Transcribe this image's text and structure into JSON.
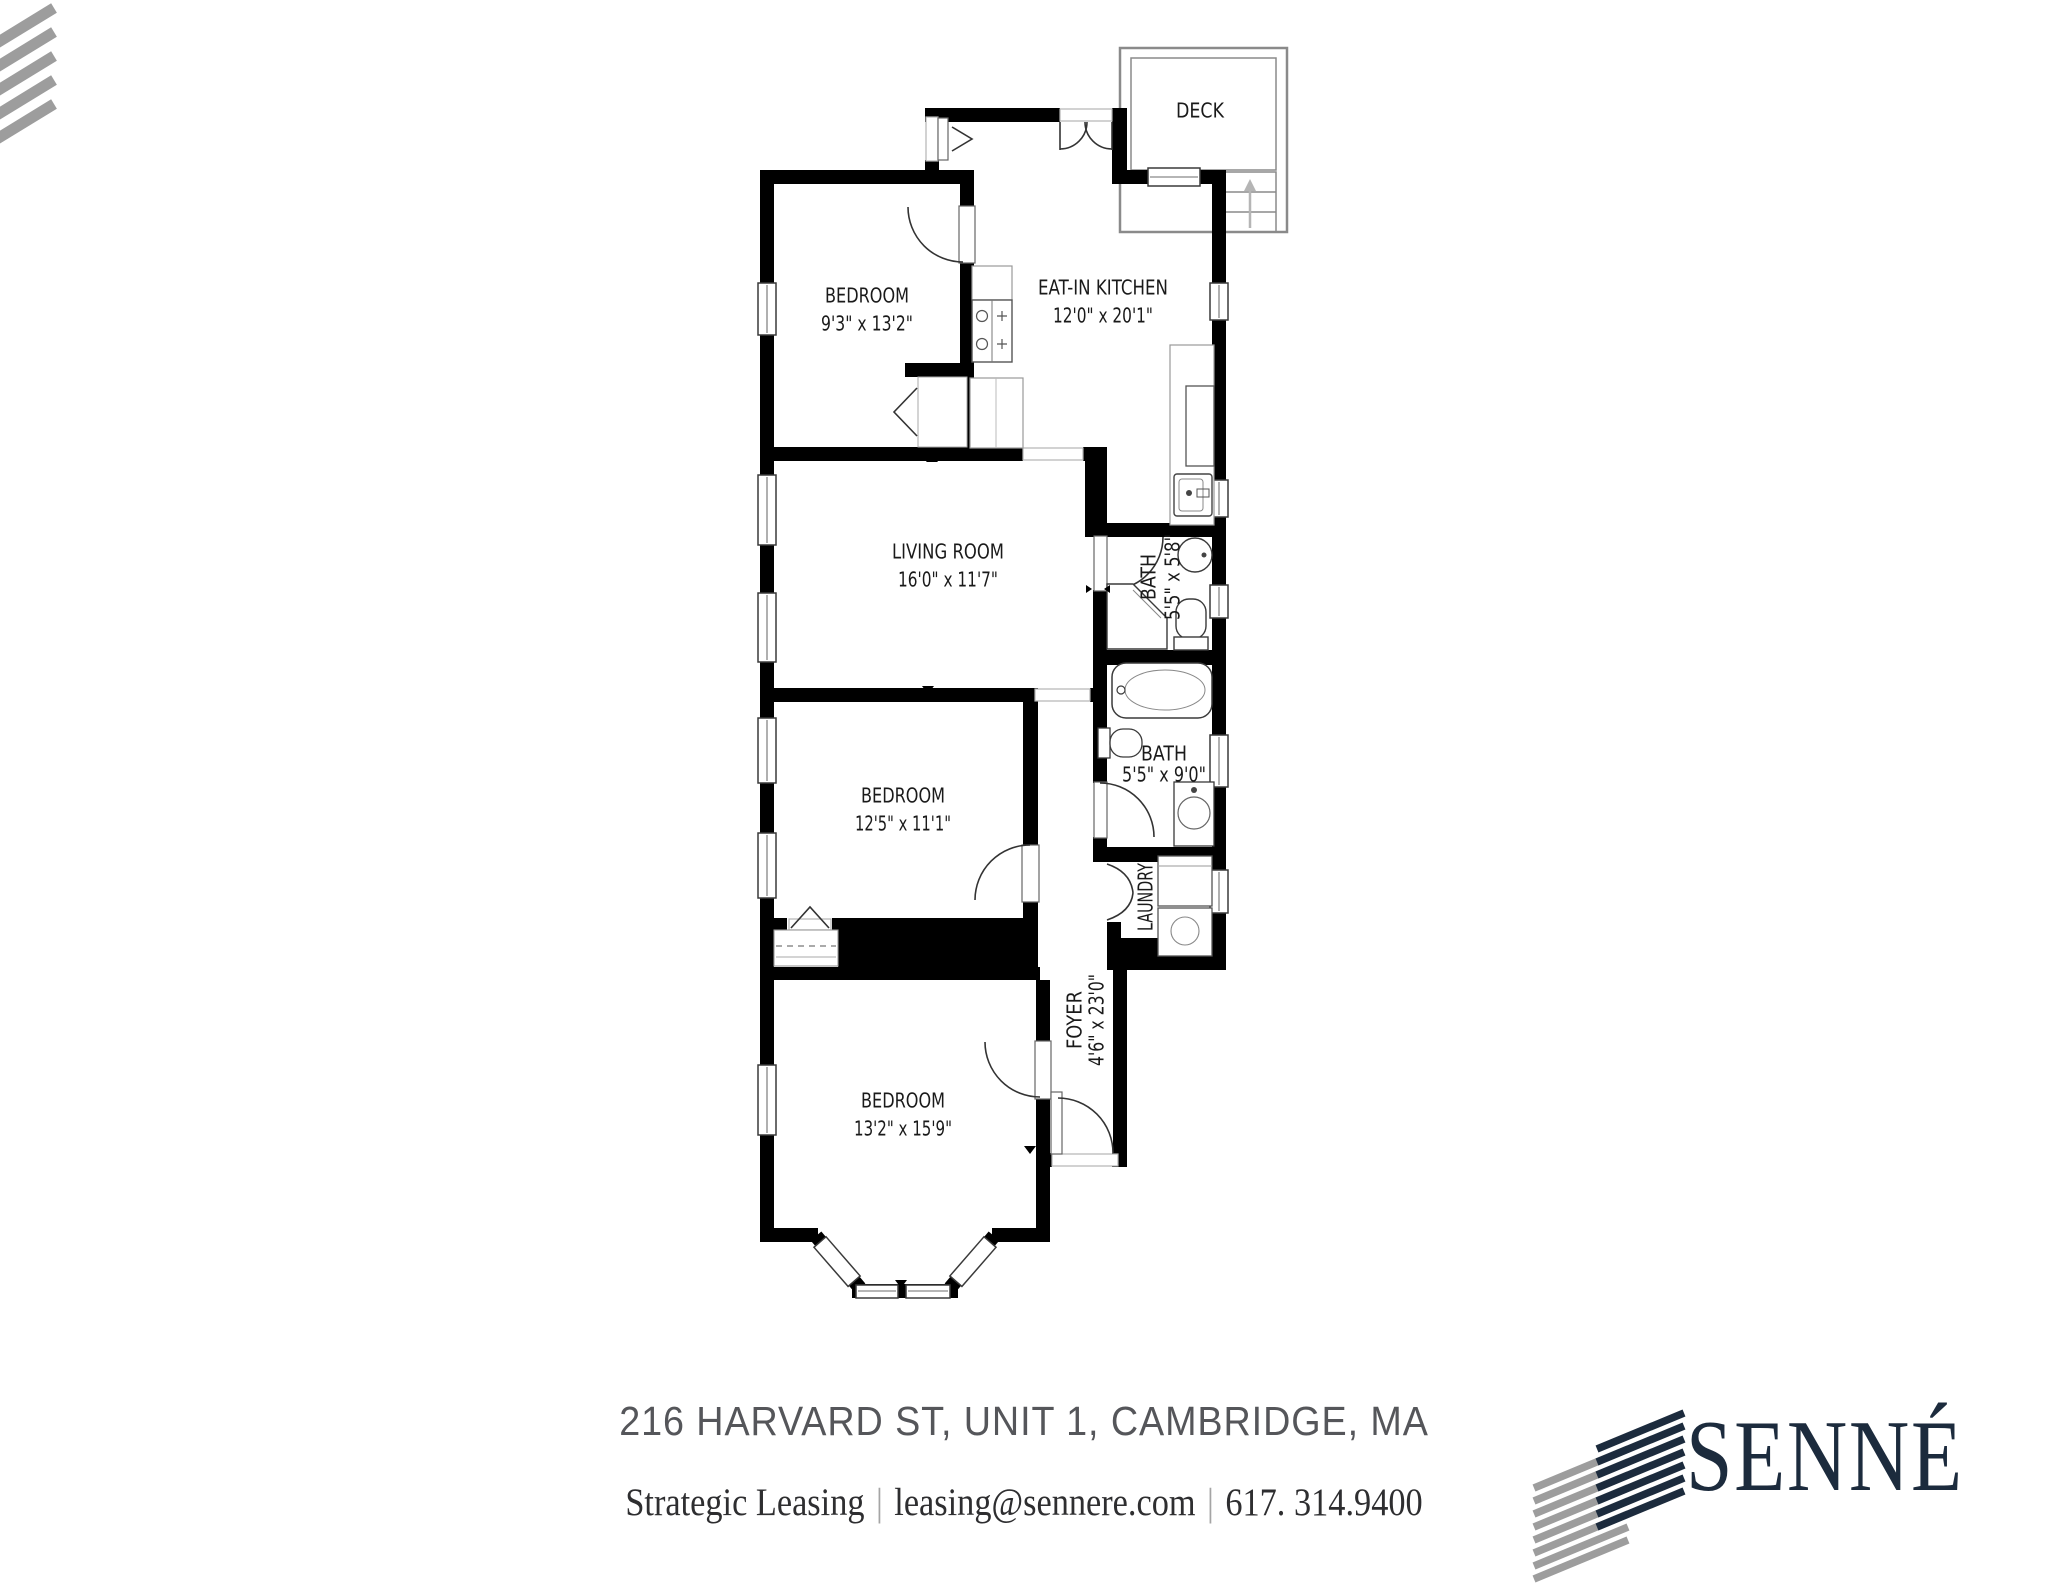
{
  "plan": {
    "wall_color": "#000000",
    "rooms": {
      "bedroom1": {
        "name": "BEDROOM",
        "dims": "9'3\" x 13'2\""
      },
      "kitchen": {
        "name": "EAT-IN KITCHEN",
        "dims": "12'0\" x 20'1\""
      },
      "deck": {
        "name": "DECK"
      },
      "living": {
        "name": "LIVING ROOM",
        "dims": "16'0\" x 11'7\""
      },
      "bath_small": {
        "name": "BATH",
        "dims": "5'5\" x 5'8\""
      },
      "bath_large": {
        "name": "BATH",
        "dims": "5'5\" x 9'0\""
      },
      "bedroom2": {
        "name": "BEDROOM",
        "dims": "12'5\" x 11'1\""
      },
      "laundry": {
        "name": "LAUNDRY"
      },
      "foyer": {
        "name": "FOYER",
        "dims": "4'6\" x 23'0\""
      },
      "bedroom3": {
        "name": "BEDROOM",
        "dims": "13'2\" x 15'9\""
      }
    }
  },
  "footer": {
    "address": "216 HARVARD ST, UNIT 1, CAMBRIDGE, MA",
    "company": "Strategic Leasing",
    "email": "leasing@sennere.com",
    "phone": "617. 314.9400",
    "separator": "|"
  },
  "branding": {
    "wordmark": "SENNÉ",
    "navy": "#1c2b3d",
    "gray": "#9d9d9d"
  }
}
